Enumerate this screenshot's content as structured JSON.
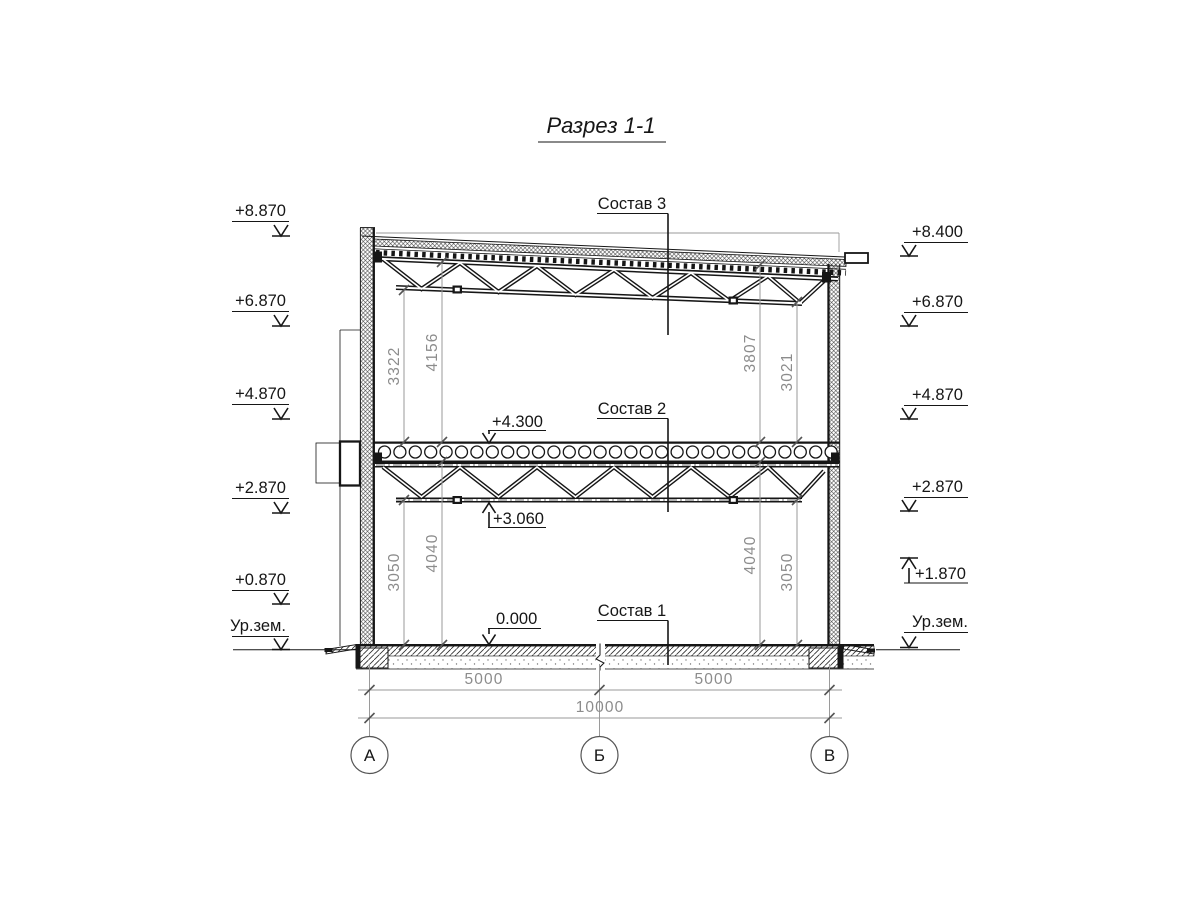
{
  "title": "Разрез 1-1",
  "composition": {
    "c3": "Состав 3",
    "c2": "Состав 2",
    "c1": "Состав 1"
  },
  "elevations_left": [
    "+8.870",
    "+6.870",
    "+4.870",
    "+2.870",
    "+0.870",
    "Ур.зем."
  ],
  "elevations_right": [
    "+8.400",
    "+6.870",
    "+4.870",
    "+2.870",
    "+1.870",
    "Ур.зем."
  ],
  "elevations_inner": {
    "slab_top": "+4.300",
    "truss_bottom": "+3.060",
    "floor": "0.000"
  },
  "dims_vertical": {
    "upper_left": [
      "3322",
      "4156"
    ],
    "upper_right": [
      "3807",
      "3021"
    ],
    "lower_left": [
      "3050",
      "4040"
    ],
    "lower_right": [
      "4040",
      "3050"
    ]
  },
  "dims_horizontal": {
    "span_left": "5000",
    "span_right": "5000",
    "total": "10000"
  },
  "axes": [
    "А",
    "Б",
    "В"
  ],
  "colors": {
    "ink": "#161616",
    "dim_gray": "#8c8c8c",
    "background": "#ffffff"
  }
}
